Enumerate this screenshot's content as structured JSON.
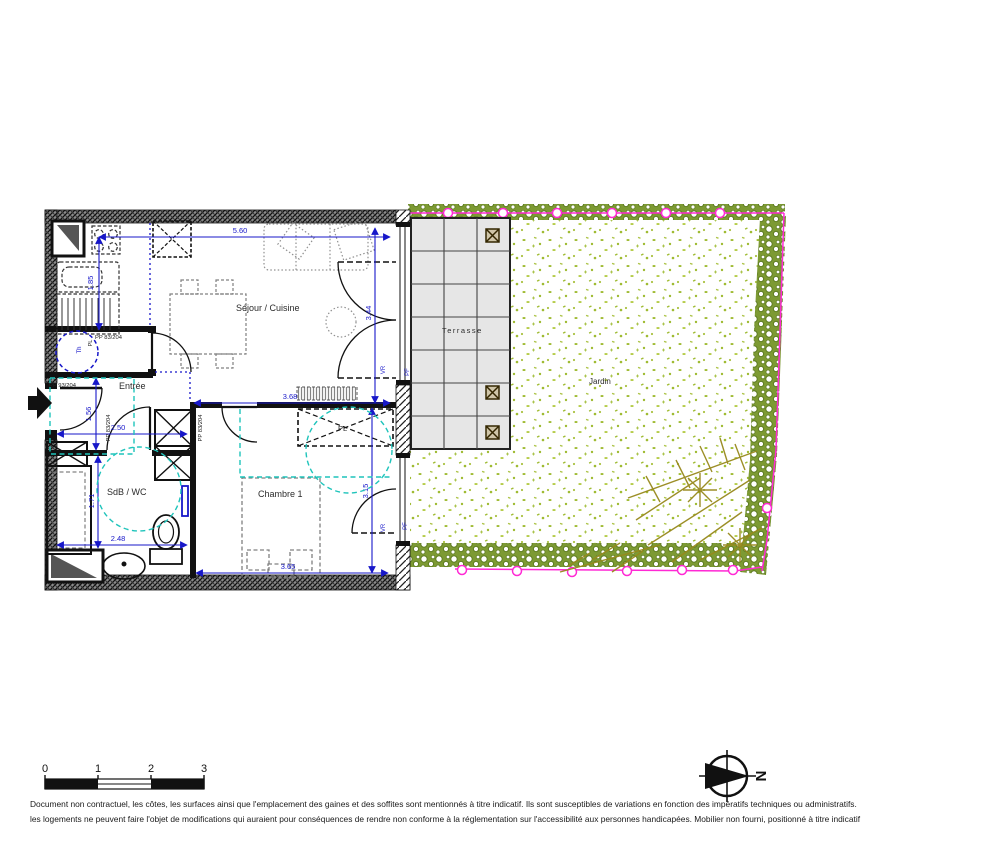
{
  "plan": {
    "rooms": {
      "sejour": "Séjour / Cuisine",
      "entree": "Entrée",
      "sdb": "SdB / WC",
      "chambre": "Chambre 1",
      "terrasse": "Terrasse",
      "jardin": "Jardin"
    },
    "dimensions": {
      "sejour_width": "5.60",
      "kitchen_depth": "1.85",
      "sejour_height": "3.44",
      "chambre_top_width": "3.68",
      "entree_width": "2.50",
      "entree_height": "1.56",
      "sdb_height": "1.71",
      "sdb_width": "2.48",
      "chambre_width": "3.65",
      "chambre_height": "3.15"
    },
    "doors": {
      "entrance": "PP 93/204",
      "living": "PP 83/204",
      "bathroom": "PP 83/204",
      "bedroom": "PP 83/204"
    },
    "marks": {
      "thermostat": "Th",
      "closet_entry": "PL",
      "closet_bedroom": "PL",
      "shutter_living": "VR",
      "shutter_bedroom": "VR",
      "french_window_living": "PF",
      "french_window_bedroom": "PF"
    }
  },
  "scale_bar": {
    "t0": "0",
    "t1": "1",
    "t2": "2",
    "t3": "3"
  },
  "compass": {
    "north": "N"
  },
  "footer": {
    "line1": "Document non contractuel, les côtes, les surfaces ainsi que l'emplacement des gaines et des soffites sont mentionnés à titre indicatif. Ils sont susceptibles de variations en fonction des impératifs techniques ou administratifs.",
    "line2": "les logements ne peuvent faire l'objet de modifications qui auraient pour conséquences de rendre non conforme à la réglementation sur l'accessibilité aux personnes handicapées. Mobilier non fourni, positionné à titre indicatif"
  },
  "colors": {
    "dimension_blue": "#1717c9",
    "accessibility_cyan": "#1fc4bb",
    "fence_magenta": "#ff29d4",
    "garden_green": "#9fbb32",
    "hedge_green": "#7d9a33",
    "branch_olive": "#97891c",
    "terrace_gray": "#e6e6e6",
    "wall_dark": "#111111"
  }
}
